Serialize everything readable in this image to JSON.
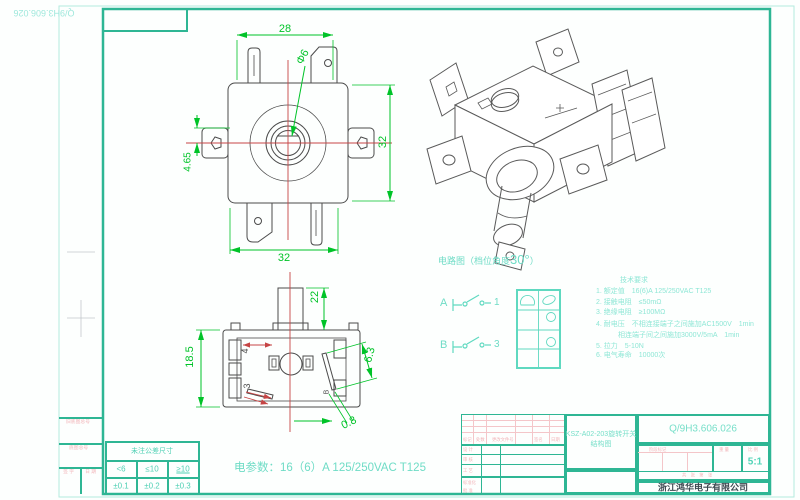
{
  "page": {
    "corner_doc_number": "Q/9H3.606.026"
  },
  "top_view": {
    "dim_width_top": "28",
    "dim_shaft_dia": "Φ6",
    "dim_height_right": "32",
    "dim_offset_left": "4.65",
    "dim_width_bottom": "32"
  },
  "front_view": {
    "dim_shaft_len": "22",
    "dim_body_height": "18.5",
    "dim_contact": "6.3",
    "dim_gap": "0.8",
    "label_terminal_4": "4",
    "label_terminal_3": "3",
    "label_b": "B"
  },
  "circuit": {
    "title_prefix": "电路图（档位角度",
    "title_angle": "30°",
    "title_suffix": "）",
    "pole_a": "A",
    "contact_1": "1",
    "pole_b": "B",
    "contact_3": "3"
  },
  "tech_req": {
    "title": "技术要求",
    "lines": [
      "1. 额定值　16(6)A 125/250VAC T125",
      "2. 接触电阻　≤50mΩ",
      "3. 绝缘电阻　≥100MΩ",
      "4. 耐电压　不相连接端子之间施加AC1500V　1min",
      "　　相连端子间之间施加3000V/5mA　1min",
      "5. 拉力　5-10N",
      "6. 电气寿命　10000次"
    ]
  },
  "elec_params": "电参数：16（6）A 125/250VAC T125",
  "tolerance_table": {
    "title": "未注公差尺寸",
    "ranges": [
      "<6",
      "≤10",
      "≥10"
    ],
    "values": [
      "±0.1",
      "±0.2",
      "±0.3"
    ]
  },
  "title_block": {
    "rev_headers": [
      "标记",
      "处数",
      "更改文件号",
      "签名",
      "日期"
    ],
    "row_labels": [
      "设 计",
      "审 核",
      "工 艺",
      "标准化",
      "批 准"
    ],
    "part_name_line1": "KSZ-A02-203旋转开关",
    "part_name_line2": "结构图",
    "doc_number": "Q/9H3.606.026",
    "stage_label": "阶段标记",
    "weight_label": "重 量",
    "scale_label": "比 例",
    "scale_value": "5:1",
    "sheet_label": "共　张　第　张",
    "company": "浙江鸿华电子有限公司"
  },
  "margin_labels": {
    "old_master": "旧底图总号",
    "master": "底图总号",
    "sign": "签 字",
    "date": "日 期"
  }
}
